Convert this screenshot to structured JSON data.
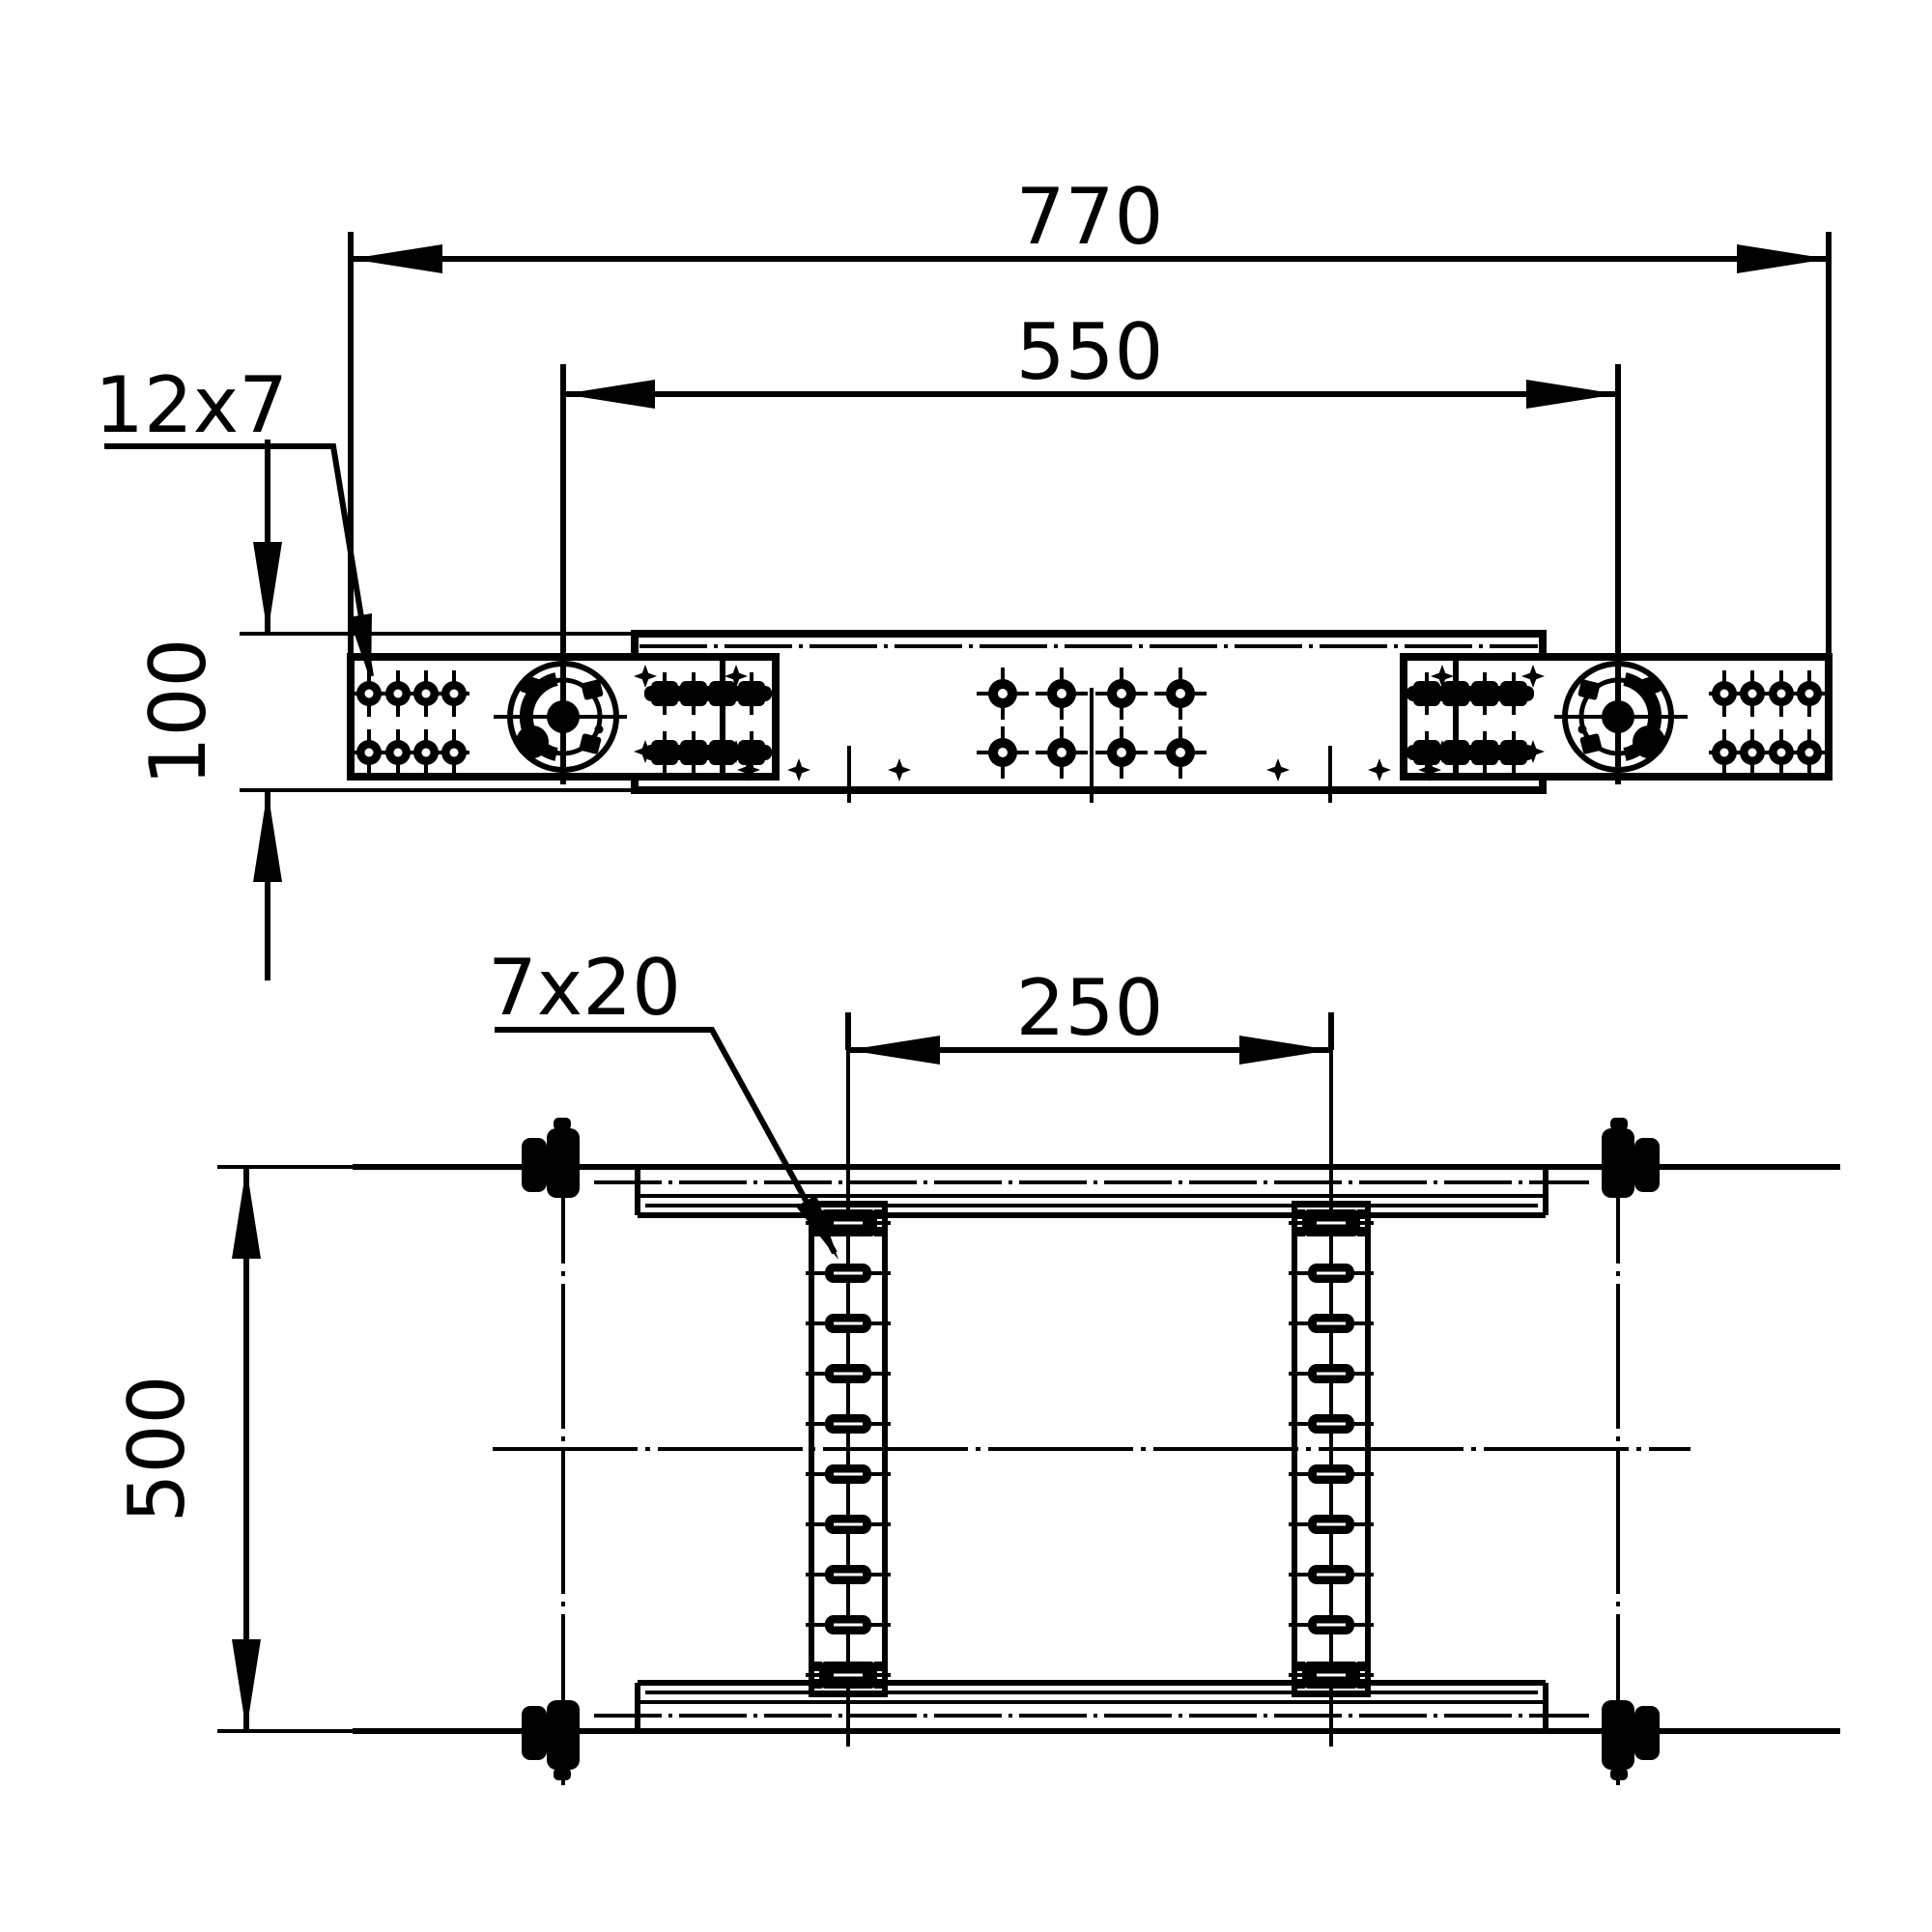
{
  "colors": {
    "ink": "#000000",
    "paper": "#ffffff"
  },
  "top_view": {
    "dim_overall_length": "770",
    "dim_pivot_spacing": "550",
    "dim_profile_height": "100",
    "hole_callout": "12x7"
  },
  "bottom_view": {
    "dim_rail_spacing": "250",
    "dim_overall_width": "500",
    "slot_callout": "7x20"
  },
  "features": {
    "slots_per_rail": 10,
    "rail_count": 2,
    "bolt_group_pattern": "2x4",
    "pivot_count": 2
  }
}
